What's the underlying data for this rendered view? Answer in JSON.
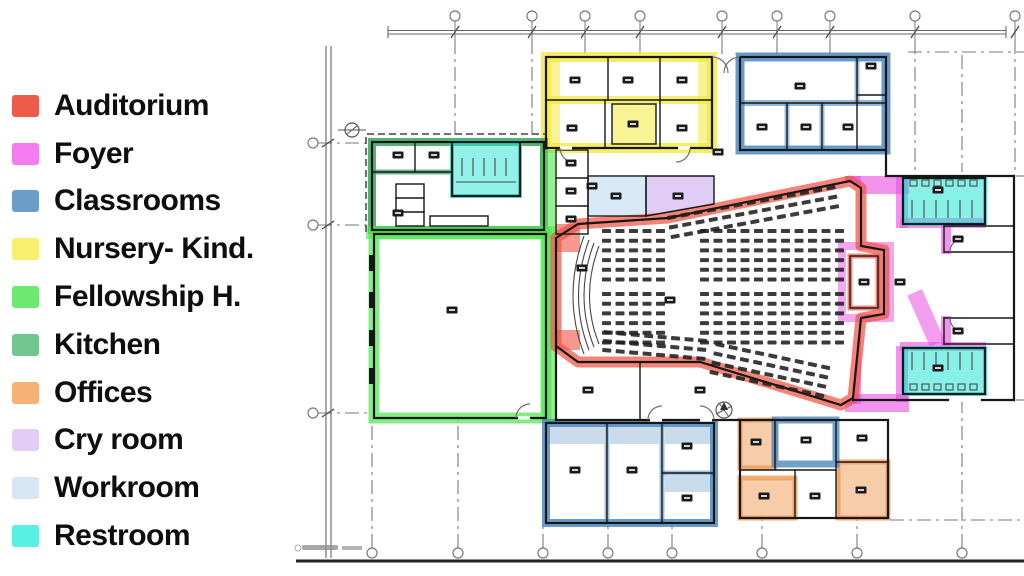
{
  "legend": {
    "items": [
      {
        "key": "auditorium",
        "label": "Auditorium",
        "color": "#EF5B4B"
      },
      {
        "key": "foyer",
        "label": "Foyer",
        "color": "#F57BF0"
      },
      {
        "key": "classrooms",
        "label": "Classrooms",
        "color": "#6D9DC9"
      },
      {
        "key": "nursery",
        "label": "Nursery- Kind.",
        "color": "#F8F06E"
      },
      {
        "key": "fellowship",
        "label": "Fellowship H.",
        "color": "#6FE96F"
      },
      {
        "key": "kitchen",
        "label": "Kitchen",
        "color": "#72C690"
      },
      {
        "key": "offices",
        "label": "Offices",
        "color": "#F7B075"
      },
      {
        "key": "cryroom",
        "label": "Cry room",
        "color": "#E2CEF5"
      },
      {
        "key": "workroom",
        "label": "Workroom",
        "color": "#D7E7F6"
      },
      {
        "key": "restroom",
        "label": "Restroom",
        "color": "#57F0E3"
      }
    ]
  },
  "colors": {
    "wall": "#161616",
    "grid": "#7a7a7a",
    "seat": "#202020",
    "plan": {
      "auditorium": "#EE5443",
      "foyer": "#E94DE2",
      "classrooms": "#4F89BE",
      "nursery": "#F2E93C",
      "fellowship": "#4FE44F",
      "kitchen": "#2E9E55",
      "offices": "#F09A52",
      "cryroom": "#DFC9F6",
      "workroom": "#D7E7F6",
      "restroom": "#25E5D5"
    }
  },
  "floor_plan": {
    "rooms": [
      {
        "name": "auditorium",
        "category": "auditorium"
      },
      {
        "name": "stage",
        "category": "auditorium"
      },
      {
        "name": "sound-booth",
        "category": "auditorium"
      },
      {
        "name": "foyer",
        "category": "foyer"
      },
      {
        "name": "classrooms-north-block",
        "category": "classrooms"
      },
      {
        "name": "classrooms-south-block",
        "category": "classrooms"
      },
      {
        "name": "classroom-in-office-wing",
        "category": "classrooms"
      },
      {
        "name": "nursery-kindergarten-block",
        "category": "nursery"
      },
      {
        "name": "fellowship-hall",
        "category": "fellowship"
      },
      {
        "name": "kitchen",
        "category": "kitchen"
      },
      {
        "name": "offices-wing",
        "category": "offices"
      },
      {
        "name": "cry-room",
        "category": "cryroom"
      },
      {
        "name": "workroom",
        "category": "workroom"
      },
      {
        "name": "restroom-by-kitchen",
        "category": "restroom"
      },
      {
        "name": "restroom-foyer-north",
        "category": "restroom"
      },
      {
        "name": "restroom-foyer-south",
        "category": "restroom"
      }
    ],
    "seat_banks": [
      {
        "x": 602,
        "y": 229,
        "rows": 6,
        "cols": 5,
        "dx": 13.5,
        "dy": 9.7
      },
      {
        "x": 700,
        "y": 229,
        "rows": 6,
        "cols": 11,
        "dx": 13.5,
        "dy": 9.7
      },
      {
        "x": 602,
        "y": 292,
        "rows": 6,
        "cols": 5,
        "dx": 13.5,
        "dy": 9.7
      },
      {
        "x": 700,
        "y": 292,
        "rows": 6,
        "cols": 11,
        "dx": 13.5,
        "dy": 9.7
      },
      {
        "x": 664,
        "y": 185,
        "rows": 3,
        "cols": 13,
        "dx": 13.5,
        "dy": 9.7,
        "angle": -10.5,
        "cx": 835,
        "cy": 185
      },
      {
        "x": 716,
        "y": 342,
        "rows": 4,
        "cols": 9,
        "dx": 13.5,
        "dy": 9.5,
        "angle": 12,
        "cx": 716,
        "cy": 342
      },
      {
        "x": 604,
        "y": 330,
        "rows": 3,
        "cols": 8,
        "dx": 13.5,
        "dy": 9,
        "angle": 5,
        "cx": 604,
        "cy": 330
      }
    ],
    "label_markers": [
      [
        575,
        80
      ],
      [
        628,
        80
      ],
      [
        682,
        80
      ],
      [
        572,
        128
      ],
      [
        633,
        124
      ],
      [
        682,
        128
      ],
      [
        800,
        86
      ],
      [
        762,
        127
      ],
      [
        806,
        127
      ],
      [
        848,
        127
      ],
      [
        871,
        66
      ],
      [
        718,
        152
      ],
      [
        592,
        186
      ],
      [
        398,
        155
      ],
      [
        434,
        155
      ],
      [
        398,
        213
      ],
      [
        452,
        310
      ],
      [
        616,
        196
      ],
      [
        678,
        196
      ],
      [
        582,
        268
      ],
      [
        670,
        300
      ],
      [
        588,
        390
      ],
      [
        700,
        390
      ],
      [
        571,
        163
      ],
      [
        571,
        191
      ],
      [
        571,
        219
      ],
      [
        864,
        282
      ],
      [
        900,
        282
      ],
      [
        938,
        190
      ],
      [
        938,
        368
      ],
      [
        958,
        239
      ],
      [
        958,
        331
      ],
      [
        756,
        442
      ],
      [
        806,
        440
      ],
      [
        862,
        438
      ],
      [
        764,
        496
      ],
      [
        815,
        496
      ],
      [
        861,
        490
      ],
      [
        575,
        470
      ],
      [
        632,
        470
      ],
      [
        687,
        446
      ],
      [
        687,
        498
      ]
    ],
    "grid": {
      "top_columns": [
        {
          "x": 455,
          "drop": 140
        },
        {
          "x": 532,
          "drop": 140
        },
        {
          "x": 585,
          "drop": 57
        },
        {
          "x": 640,
          "drop": 57
        },
        {
          "x": 722,
          "drop": 57
        },
        {
          "x": 777,
          "drop": 57
        },
        {
          "x": 830,
          "drop": 57
        },
        {
          "x": 915,
          "drop": 176
        },
        {
          "x": 1015,
          "drop": 170
        }
      ],
      "bottom_columns": [
        {
          "x": 372,
          "top": 420
        },
        {
          "x": 458,
          "top": 420
        },
        {
          "x": 543,
          "top": 523
        },
        {
          "x": 608,
          "top": 523
        },
        {
          "x": 672,
          "top": 523
        },
        {
          "x": 762,
          "top": 518
        },
        {
          "x": 857,
          "top": 518
        },
        {
          "x": 962,
          "top": 402
        }
      ],
      "left_rows": [
        143,
        225,
        413
      ]
    }
  }
}
